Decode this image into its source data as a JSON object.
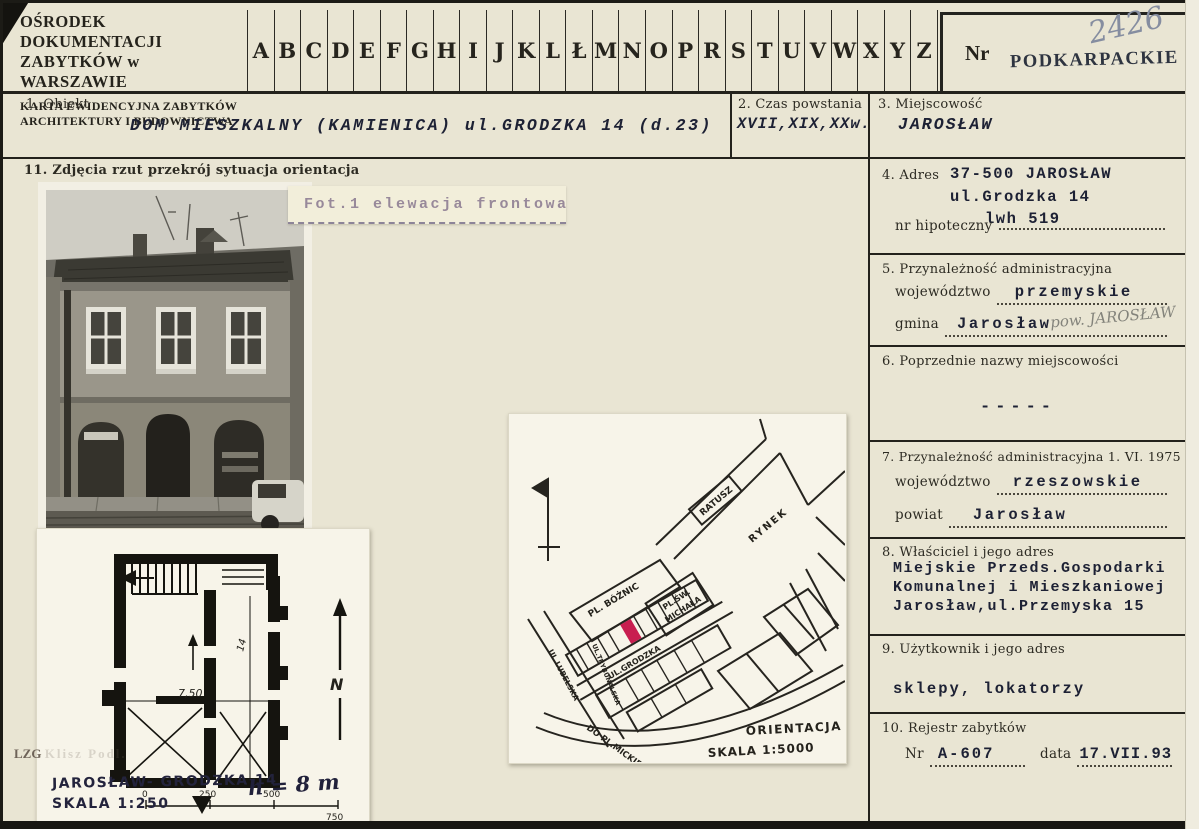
{
  "header": {
    "org_line1": "OŚRODEK DOKUMENTACJI",
    "org_line2": "ZABYTKÓW w WARSZAWIE",
    "card_line1": "KARTA EWIDENCYJNA ZABYTKÓW",
    "card_line2": "ARCHITEKTURY I BUDOWNICTWA",
    "letters": [
      "A",
      "B",
      "C",
      "D",
      "E",
      "F",
      "G",
      "H",
      "I",
      "J",
      "K",
      "L",
      "Ł",
      "M",
      "N",
      "O",
      "P",
      "R",
      "S",
      "T",
      "U",
      "V",
      "W",
      "X",
      "Y",
      "Z"
    ],
    "nr_label": "Nr",
    "region_stamp": "PODKARPACKIE",
    "card_number": "2426"
  },
  "fields": {
    "obiekt": {
      "label": "1. Obiekt",
      "value": "DOM MIESZKALNY (KAMIENICA) ul.GRODZKA 14 (d.23)"
    },
    "czas": {
      "label": "2. Czas powstania",
      "value": "XVII,XIX,XXw."
    },
    "miejscowosc": {
      "label": "3. Miejscowość",
      "value": "JAROSŁAW"
    },
    "adres": {
      "label": "4. Adres",
      "line1": "37-500 JAROSŁAW",
      "line2": "ul.Grodzka 14",
      "line3": "lwh 519",
      "hipoteczny_label": "nr hipoteczny"
    },
    "admin": {
      "label": "5. Przynależność administracyjna",
      "woj_label": "województwo",
      "woj": "przemyskie",
      "gmina_label": "gmina",
      "gmina": "Jarosław",
      "handwritten": "pow. JAROSŁAW"
    },
    "poprzednie": {
      "label": "6. Poprzednie nazwy miejscowości",
      "value": "-----"
    },
    "admin1975": {
      "label": "7. Przynależność administracyjna 1. VI. 1975 r.",
      "woj_label": "województwo",
      "woj": "rzeszowskie",
      "powiat_label": "powiat",
      "powiat": "Jarosław"
    },
    "wlasciciel": {
      "label": "8. Właściciel i jego adres",
      "line1": "Miejskie Przeds.Gospodarki",
      "line2": "Komunalnej i Mieszkaniowej",
      "line3": "Jarosław,ul.Przemyska 15"
    },
    "uzytkownik": {
      "label": "9. Użytkownik i jego adres",
      "value": "sklepy, lokatorzy"
    },
    "rejestr": {
      "label": "10. Rejestr zabytków",
      "nr_label": "Nr",
      "nr": "A-607",
      "data_label": "data",
      "data": "17.VII.93"
    },
    "zdjecia": {
      "label": "11. Zdjęcia rzut przekrój sytuacja orientacja"
    }
  },
  "photo": {
    "caption": "Fot.1 elewacja frontowa"
  },
  "plan": {
    "title": "JAROSŁAW- GRODZKA 14",
    "scale": "SKALA 1:250",
    "height_note": "h = 8 m",
    "dim_width": "7,50",
    "dim_height": "14",
    "north": "N",
    "ticks": [
      "0",
      "250",
      "500",
      "750"
    ],
    "corner_mark": "LZG",
    "corner_mark_faint": "Klisz Podl."
  },
  "map": {
    "ratusz": "RATUSZ",
    "rynek": "RYNEK",
    "pl_boznic": "PL. BÓŻNIC",
    "pl_sw_1": "PL.ŚW.",
    "pl_sw_2": "MICHAŁA",
    "ul_grodzka": "UL.GRODZKA",
    "ul_lubelska": "UL.LUBELSKA",
    "ul_side": "UL.TRYBUNALSKA",
    "do_pl": "DO PL.MICKIEWICZA",
    "orientacja": "ORIENTACJA",
    "skala": "SKALA 1:5000"
  },
  "colors": {
    "highlight": "#c81e50",
    "paper": "#e9e5d3",
    "ink": "#24221c"
  }
}
